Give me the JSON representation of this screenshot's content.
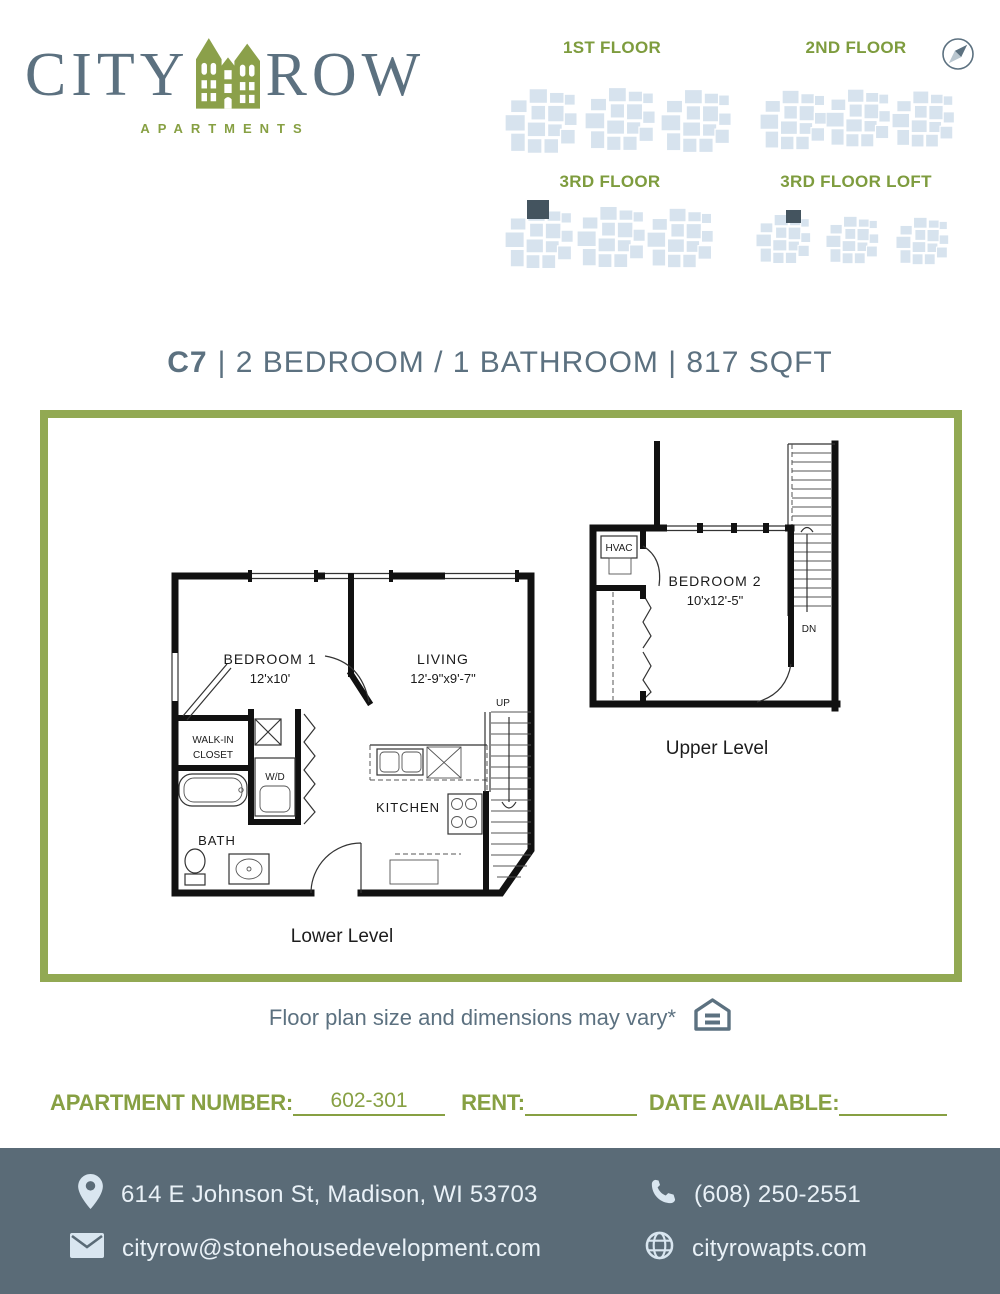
{
  "logo": {
    "city": "CITY",
    "row": "ROW",
    "subtitle": "APARTMENTS"
  },
  "floor_maps": {
    "labels": [
      "1ST FLOOR",
      "2ND FLOOR",
      "3RD FLOOR",
      "3RD FLOOR LOFT"
    ]
  },
  "title": {
    "code": "C7",
    "rest": "| 2 BEDROOM / 1 BATHROOM | 817 SQFT"
  },
  "plan": {
    "lower": {
      "title": "Lower Level",
      "bedroom1": "BEDROOM 1",
      "bedroom1_dims": "12'x10'",
      "living": "LIVING",
      "living_dims": "12'-9\"x9'-7\"",
      "walkin_line1": "WALK-IN",
      "walkin_line2": "CLOSET",
      "wd": "W/D",
      "bath": "BATH",
      "kitchen": "KITCHEN",
      "up": "UP"
    },
    "upper": {
      "title": "Upper Level",
      "bedroom2": "BEDROOM 2",
      "bedroom2_dims": "10'x12'-5\"",
      "hvac": "HVAC",
      "dn": "DN"
    }
  },
  "disclaimer": "Floor plan size and dimensions may vary*",
  "form": {
    "apartment_number_label": "APARTMENT NUMBER:",
    "apartment_number_value": "602-301",
    "rent_label": "RENT:",
    "rent_value": "",
    "date_available_label": "DATE AVAILABLE:",
    "date_available_value": ""
  },
  "footer": {
    "address": "614 E Johnson St, Madison, WI 53703",
    "phone": "(608) 250-2551",
    "email": "cityrow@stonehousedevelopment.com",
    "website": "cityrowapts.com"
  },
  "colors": {
    "olive_text": "#87a043",
    "olive_border": "#92a953",
    "slate": "#5c7180",
    "footer_bg": "#5a6b77",
    "map_fill": "#d7e3ee",
    "unit_highlight": "#44545f"
  }
}
